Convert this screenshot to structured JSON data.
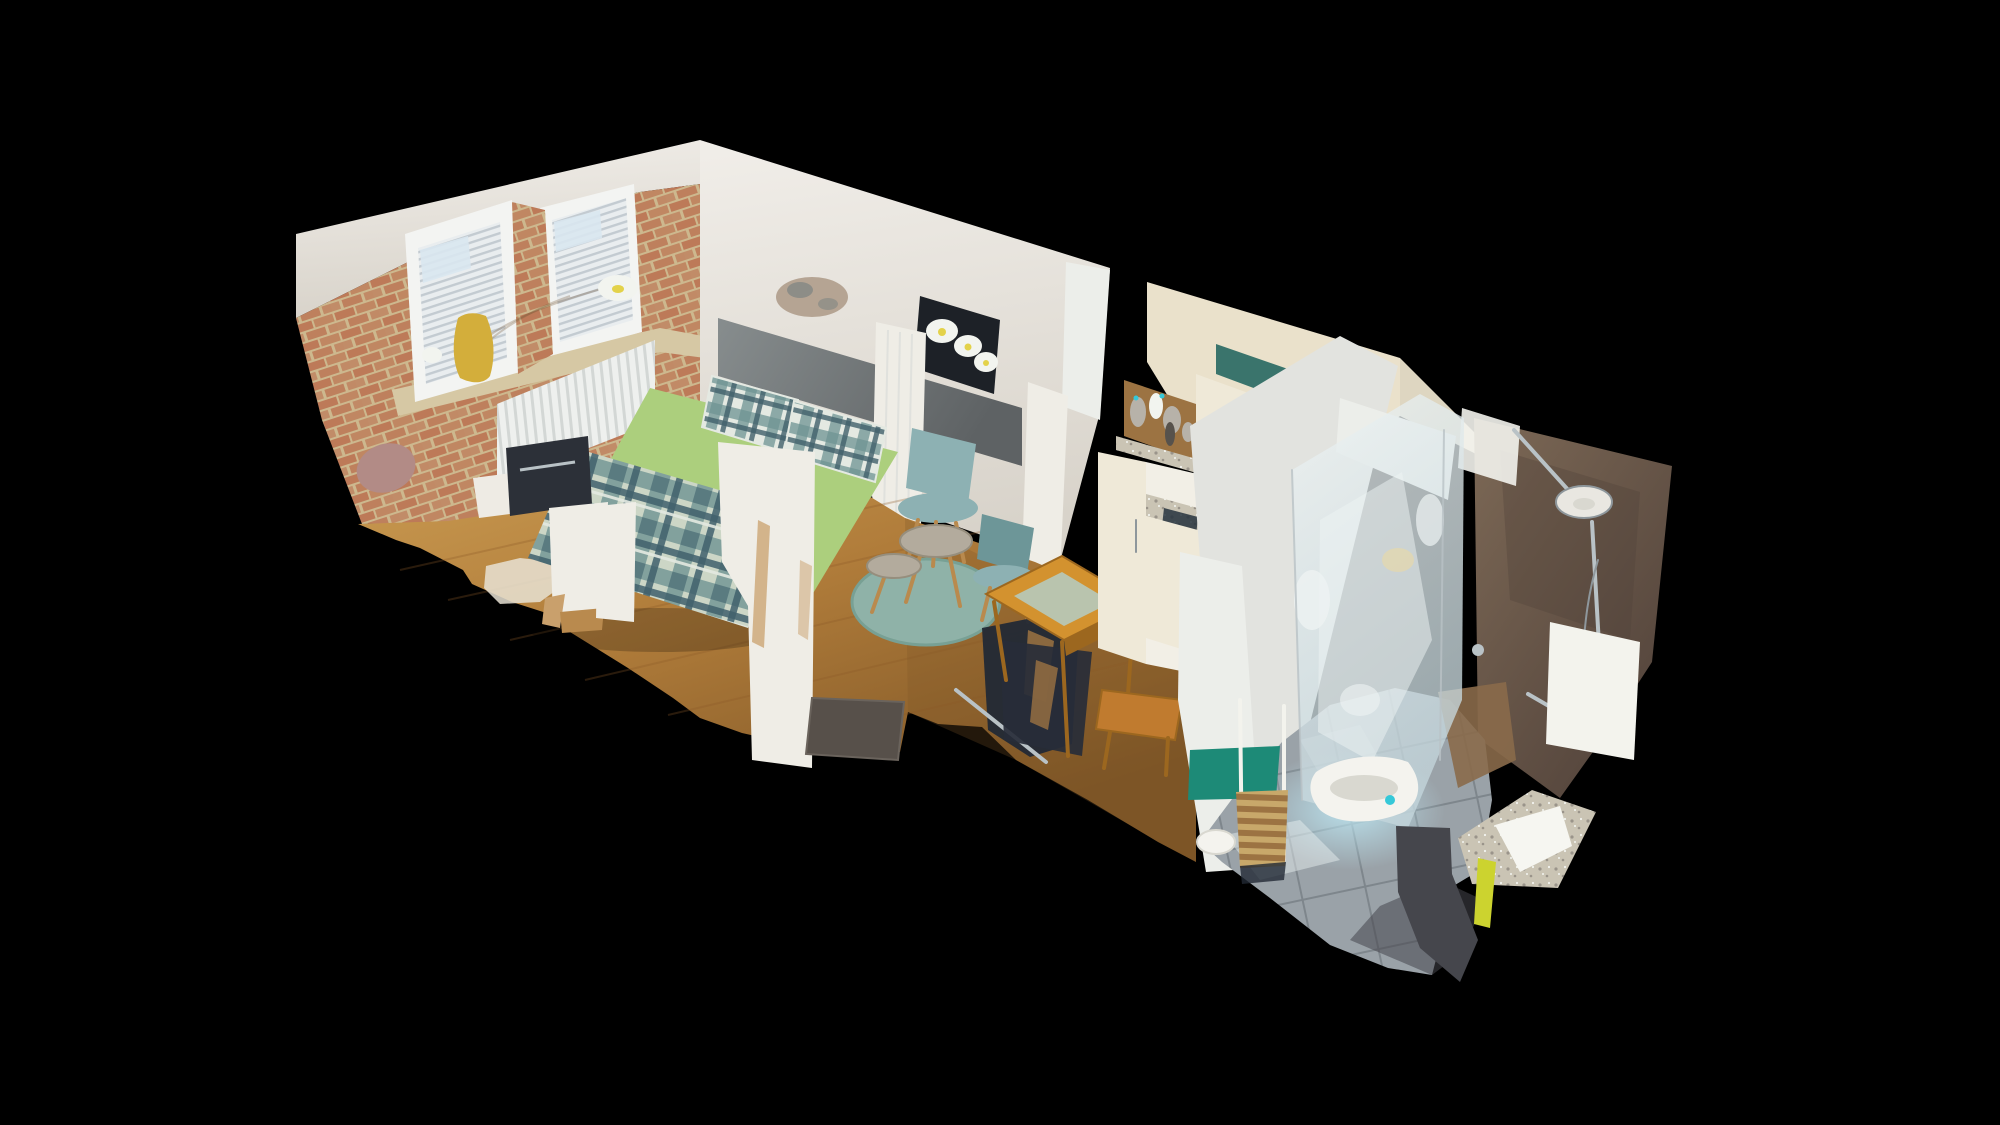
{
  "meta": {
    "view_mode": "dollhouse",
    "background": "#000000"
  },
  "scene": {
    "description": "Isometric dollhouse cutaway 3D scan of a studio apartment with bedroom, kitchenette and bathroom floating on a black background",
    "rooms": [
      {
        "name": "bedroom",
        "objects": [
          "double bed with green sheets and plaid duvet",
          "two plaid pillows",
          "grey headboard panel",
          "exposed brick wall",
          "two windows with pleated blinds",
          "yellow vase with blossom branch",
          "white radiator",
          "white vanity table",
          "sheepskin rug"
        ]
      },
      {
        "name": "living-area",
        "objects": [
          "flower canvas print",
          "two teal shell chairs",
          "two round concrete coffee tables",
          "round teal rug",
          "wooden dining table",
          "grey doormat",
          "dark coat rack",
          "wooden stool"
        ]
      },
      {
        "name": "kitchenette",
        "objects": [
          "cream cabinets",
          "open teal-backed cabinet",
          "figurine shelf",
          "granite counter with sink",
          "drawer unit"
        ]
      },
      {
        "name": "bathroom",
        "objects": [
          "walk-in glass shower",
          "bronze tiled wall",
          "chrome shower set",
          "white wash basin",
          "grey tiled floor",
          "petrol towel",
          "bamboo shelf trolley",
          "granite counter",
          "yellow towel"
        ]
      }
    ]
  },
  "palette": {
    "background": "#000000",
    "wallWhiteTop": "#f1eee9",
    "wallShade": "#d8d3ca",
    "brickTan": "#cdb88e",
    "brickRed": "#bd7a58",
    "stoneSill": "#d6c8a4",
    "windowFrame": "#f3f4f2",
    "blindLight": "#e9edef",
    "blindShade": "#c3cbd1",
    "skyGlass": "#d9e7ef",
    "vaseYellow": "#d3ae3b",
    "branchBrown": "#7a5c3a",
    "flowerWhite": "#f2f4ef",
    "flowerYellow": "#e3d24a",
    "radiatorLight": "#eef0ee",
    "radiatorShade": "#d3d7d5",
    "headboardDark": "#5e6264",
    "headboardLight": "#878d8e",
    "mattressGreen": "#accf7d",
    "mattressGreenDark": "#8fb95f",
    "mattressSeam": "#dcefc4",
    "plaidBase": "#ccd6c6",
    "plaidTeal": "#6f9492",
    "plaidDark": "#41606c",
    "pillowTint": "#e4e9e2",
    "artFrame": "#1d2127",
    "chairTeal": "#8db1b3",
    "chairTealDark": "#6d9698",
    "chairLegWood": "#b98a4e",
    "rugTeal": "#8fb2a8",
    "rugTealDark": "#78a094",
    "tableConcrete": "#b3ab9d",
    "tableConcreteDark": "#968e7d",
    "doormat": "#57504a",
    "doormatEdge": "#6a635c",
    "deskWhite": "#eeebe4",
    "deskObject": "#2c3038",
    "smudgePink": "#b28b86",
    "sheepskin": "#e8e2d4",
    "diningWood": "#d3922f",
    "diningWoodDark": "#9c671f",
    "placematSage": "#b9c4ae",
    "underTableDark": "#272d38",
    "kitchenCream": "#eae1cb",
    "cabinetCream": "#efe9d8",
    "cabinetWhite": "#f2efe6",
    "cabinetShade": "#dcd5c2",
    "tealCabinet": "#3a746c",
    "navyDark": "#26323d",
    "nicheWood": "#9c7342",
    "figurineGray": "#b7b2a9",
    "figurineDark": "#57524c",
    "graniteSpeckleBase": "#cac4b4",
    "graniteSpeckDark": "#9a948a",
    "graniteBright": "#f6f6f1",
    "partitionLight": "#e2e3df",
    "partitionLight2": "#eceeea",
    "glassBlue": "#c4d6dc",
    "glassWhite": "#eef3f3",
    "warmGlow": "#e8d9a8",
    "bathTile": "#9aa2a8",
    "bathTileGrout": "#7e868c",
    "lightCyan": "#bfeaf6",
    "showerBase": "#8a6a4a",
    "basinWhite": "#f4f3ee",
    "basinShadow": "#d9d8d0",
    "cyanDot": "#35c8d8",
    "towelTeal": "#1d8a77",
    "slatWood": "#c8a86a",
    "brownTileLight": "#7d6956",
    "brownTileDark": "#51423a",
    "chrome": "#b9c2c6",
    "chromeDark": "#8e979c",
    "showerHead": "#e9e7e1",
    "panelWhite": "#f3f3ed",
    "darkTile": "#45464c",
    "towelYellow": "#ccd32f",
    "stoolWood": "#c07b2f",
    "rackDark": "#222935",
    "woodLight": "#cfa156",
    "wood": "#b07c3a",
    "woodDark": "#7d5526",
    "woodSeam": "#8a5a28",
    "columnWhite": "#efede6",
    "tornTan": "#c9a06c",
    "wallHole": "#b5a493",
    "holeGray": "#8d8d87"
  }
}
